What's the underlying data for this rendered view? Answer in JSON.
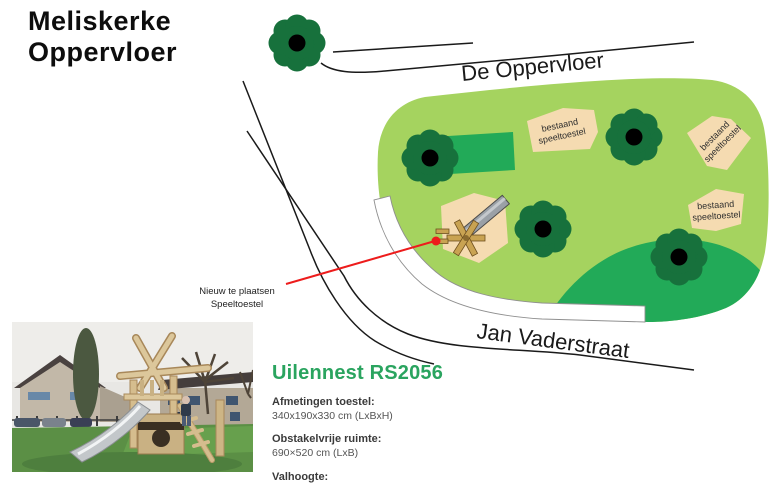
{
  "title": {
    "line1": "Meliskerke",
    "line2": "Oppervloer"
  },
  "streets": {
    "top": "De Oppervloer",
    "bottom": "Jan Vaderstraat"
  },
  "existing_equipment": [
    {
      "line1": "bestaand",
      "line2": "speeltoestel"
    },
    {
      "line1": "bestaand",
      "line2": "speeltoestel"
    },
    {
      "line1": "bestaand",
      "line2": "speeltoestel"
    }
  ],
  "annotation": {
    "line1": "Nieuw te plaatsen",
    "line2": "Speeltoestel"
  },
  "product": {
    "name": "Uilennest RS2056",
    "specs": [
      {
        "label": "Afmetingen toestel:",
        "value": "340x190x330 cm (LxBxH)"
      },
      {
        "label": "Obstakelvrije ruimte:",
        "value": "690×520 cm (LxB)"
      },
      {
        "label": "Valhoogte:",
        "value": "100 cm"
      }
    ]
  },
  "colors": {
    "park_light_green": "#a5d35f",
    "field_medium_green": "#22aa58",
    "tree_dark_green": "#17713c",
    "equipment_beige": "#f5dbb1",
    "pointer_red": "#ed1c1c",
    "heading_green": "#2aa45f",
    "road_line_black": "#1a1a1a"
  }
}
